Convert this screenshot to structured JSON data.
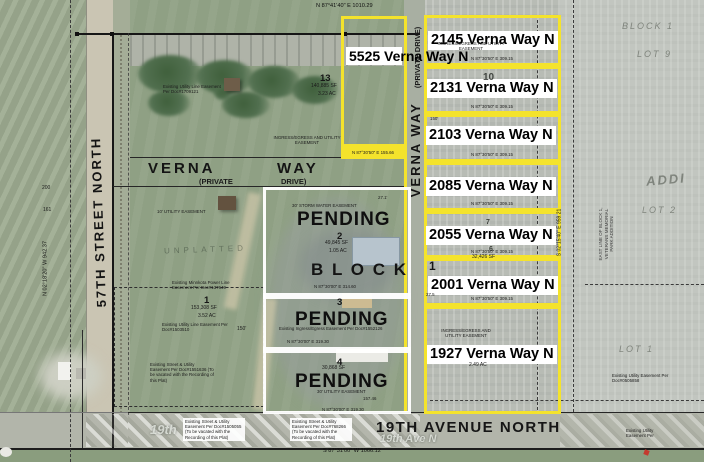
{
  "canvas": {
    "width": 704,
    "height": 462
  },
  "colors": {
    "highlight_yellow": "#f4e32c",
    "outline_white": "#ffffff"
  },
  "streets": {
    "left": "57TH STREET NORTH",
    "verna": "VERNA",
    "way": "WAY",
    "private": "(PRIVATE",
    "drive": "DRIVE)",
    "verna_vertical_main": "VERNA    WAY",
    "verna_vertical_sub": "(PRIVATE   DRIVE)",
    "bottom": "19TH AVENUE NORTH",
    "bottom_ghost": "19th Ave N",
    "left_ghost": "19th"
  },
  "bearings": {
    "north": "N 87°41'40\" E  1010.29",
    "west": "N 02°18'20\" W 942.37",
    "east": "S 02°15'40\" E  959.21",
    "south": "S 87°31'00\" W  1066.12",
    "lot5525_south": "N 87°30'50\" E  155.66",
    "row": "N 87°30'50\" E  309.15",
    "lot2_south": "N 87°30'00\" E  314.60",
    "lot3_south": "N 87°30'00\" E  319.30"
  },
  "addresses": {
    "a5525": "5525\nVerna\nWay N",
    "a2145": "2145 Verna Way N",
    "a2131": "2131 Verna Way N",
    "a2103": "2103 Verna Way N",
    "a2085": "2085 Verna Way N",
    "a2055": "2055 Verna Way N",
    "a2001": "2001 Verna Way N",
    "a1927": "1927 Verna Way N"
  },
  "status": {
    "pending": "PENDING",
    "block": "B L O C K"
  },
  "lots": {
    "n13": "13",
    "sf13": "140,885 SF",
    "ac13": "3.23 AC",
    "n1": "1",
    "sf1": "153,308 SF",
    "ac1": "3.52 AC",
    "n2": "2",
    "sf2": "49,845 SF",
    "ac2": "1.05 AC",
    "n3": "3",
    "n4": "4",
    "sf4": "30,868 SF",
    "n6": "6",
    "sf6": "32,426 SF",
    "n7": "7",
    "n10": "10",
    "big1": "1",
    "ac1927": "2.49 AC"
  },
  "easements": {
    "ingress_utility": "INGRESS/EGRESS AND UTILITY EASEMENT",
    "storm_water": "30' STORM WATER EASEMENT",
    "utility_30": "30' UTILITY EASEMENT",
    "utility_10": "10' UTILITY EASEMENT",
    "doc1709121": "Existing Utility Line Easement Per Doc#1709121",
    "minnkota": "Existing Minnkota Power Line Easement Per Doc#137649",
    "doc1503510": "Existing Utility Line Easement Per Doc#1503510",
    "doc1551636": "Existing Street & Utility Easement Per Doc#1551636 (To be vacated with the Recording of this Plat)",
    "doc1505055": "Existing Street & Utility Easement Per Doc#1505055 (To be vacated with the Recording of this Plat)",
    "doc768266": "Existing Street & Utility Easement Per Doc#768266 (To be vacated with the Recording of this Plat)",
    "doc1552126": "Existing Ingress/Egress Easement Per Doc#1552126",
    "doc0505858": "Existing Utility Easement Per Doc#0505858",
    "utility_partial": "Existing Utility Easement Per",
    "east_line": "EAST LINE OF BLOCK 1,\nVETERANS MEMORIAL\nPARK ADDITION"
  },
  "dims": {
    "d150": "150'",
    "d157": "157.46",
    "d271": "27.1'",
    "d275": "27.5",
    "d200": "200",
    "d161": "161"
  },
  "ghost": {
    "block1": "BLOCK 1",
    "lot9": "LOT 9",
    "lot2": "LOT 2",
    "lot1": "LOT 1",
    "addition": "ADDI",
    "unplatted": "UNPLATTED"
  }
}
